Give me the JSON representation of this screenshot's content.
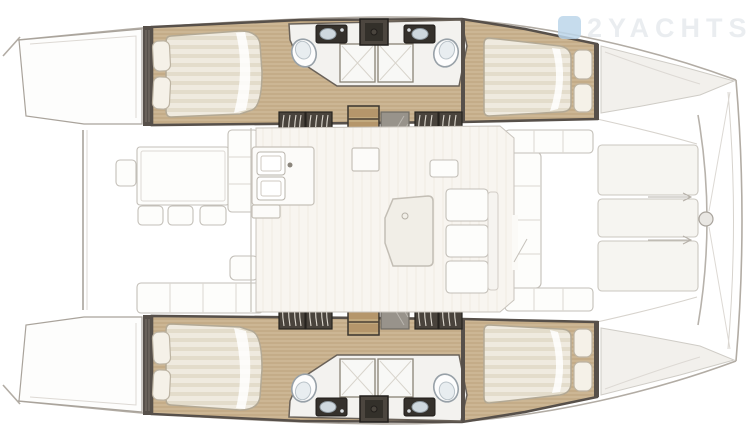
{
  "watermark": {
    "brand_text": "2YACHTS",
    "icon": "watermark-logo-square"
  },
  "diagram": {
    "type": "yacht-deck-plan",
    "vessel": "catamaran-top-view",
    "areas": [
      {
        "id": "aft-deck",
        "label": "Aft cockpit: dining table, four chairs, bench seating"
      },
      {
        "id": "port-hull",
        "label": "Port hull: aft double cabin, two heads with showers, forward double cabin, forepeak"
      },
      {
        "id": "starboard-hull",
        "label": "Starboard hull: aft double cabin, two heads with showers, forward double cabin, forepeak"
      },
      {
        "id": "salon",
        "label": "Salon: galley with twin sinks, chart table, settee, companionway stairs"
      },
      {
        "id": "forward-cockpit",
        "label": "Forward cockpit C-shaped seating"
      },
      {
        "id": "foredeck",
        "label": "Foredeck panels, bow crossbeam and windlass"
      }
    ]
  },
  "colors": {
    "background": "#ffffff",
    "wall-dark": "#57504a",
    "wood-floor": "#ccb694",
    "wood-grain": "#c0a781",
    "wood-steps": "#b5966b",
    "bed-linen": "#efeadf",
    "bed-band": "#e3dccb",
    "pillow": "#f5f1e8",
    "bathroom-white": "#f3f2ef",
    "fixture-dark": "#35312c",
    "sink-basin": "#cfd8de",
    "outline-gray": "#a9a39b",
    "faint-gray": "#cbc7c0",
    "watermark-blue": "#bcd6ea",
    "watermark-text": "#e9edf0"
  }
}
